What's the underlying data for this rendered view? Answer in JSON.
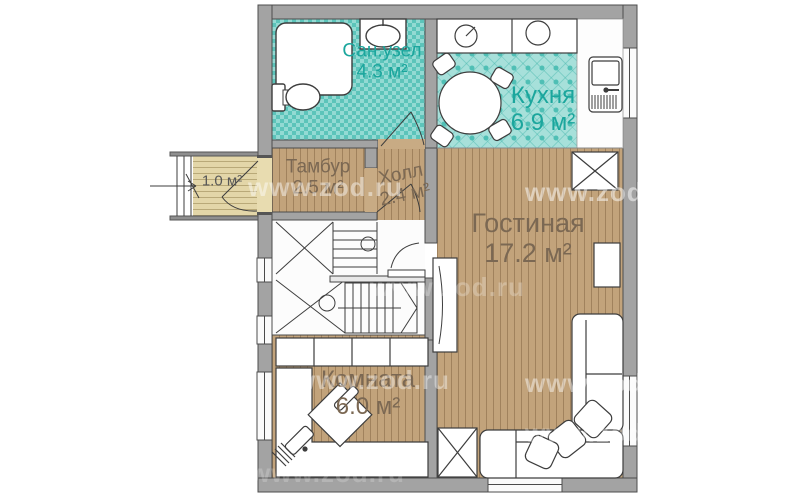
{
  "watermark": {
    "text": "www.zod.ru"
  },
  "rooms": {
    "bathroom": {
      "name": "Сан.узел",
      "area": "4.3 м²"
    },
    "kitchen": {
      "name": "Кухня",
      "area": "6.9 м²"
    },
    "vestibule": {
      "name": "Тамбур",
      "area": "2.5 м²"
    },
    "hall": {
      "name": "Холл",
      "area": "2.4 м²"
    },
    "living": {
      "name": "Гостиная",
      "area": "17.2 м²"
    },
    "bedroom": {
      "name": "Комната",
      "area": "6.0 м²"
    },
    "porch": {
      "area": "1.0 м²"
    }
  },
  "fixtures": [
    "shower-icon",
    "washbasin-icon",
    "toilet-icon",
    "stove-icon",
    "kitchen-sink-icon",
    "dining-table-icon",
    "chair-icon",
    "wardrobe-icon",
    "sofa-icon",
    "pillow-icon",
    "desk-icon",
    "office-chair-icon",
    "staircase-icon",
    "entry-steps-icon",
    "door-arc-icon",
    "window-icon",
    "tv-cabinet-icon",
    "radiator-icon"
  ],
  "colors": {
    "wall": "#a3a3a3",
    "wall_edge": "#4c4c4c",
    "wood_floor": "#c2a37b",
    "bath_tile": "#93dad3",
    "tile_accent": "#5cc4ba",
    "porch_floor": "#e3d6a8",
    "label_teal": "#1ba69d",
    "label_brown": "#7b6853",
    "label_gray": "#585858"
  }
}
